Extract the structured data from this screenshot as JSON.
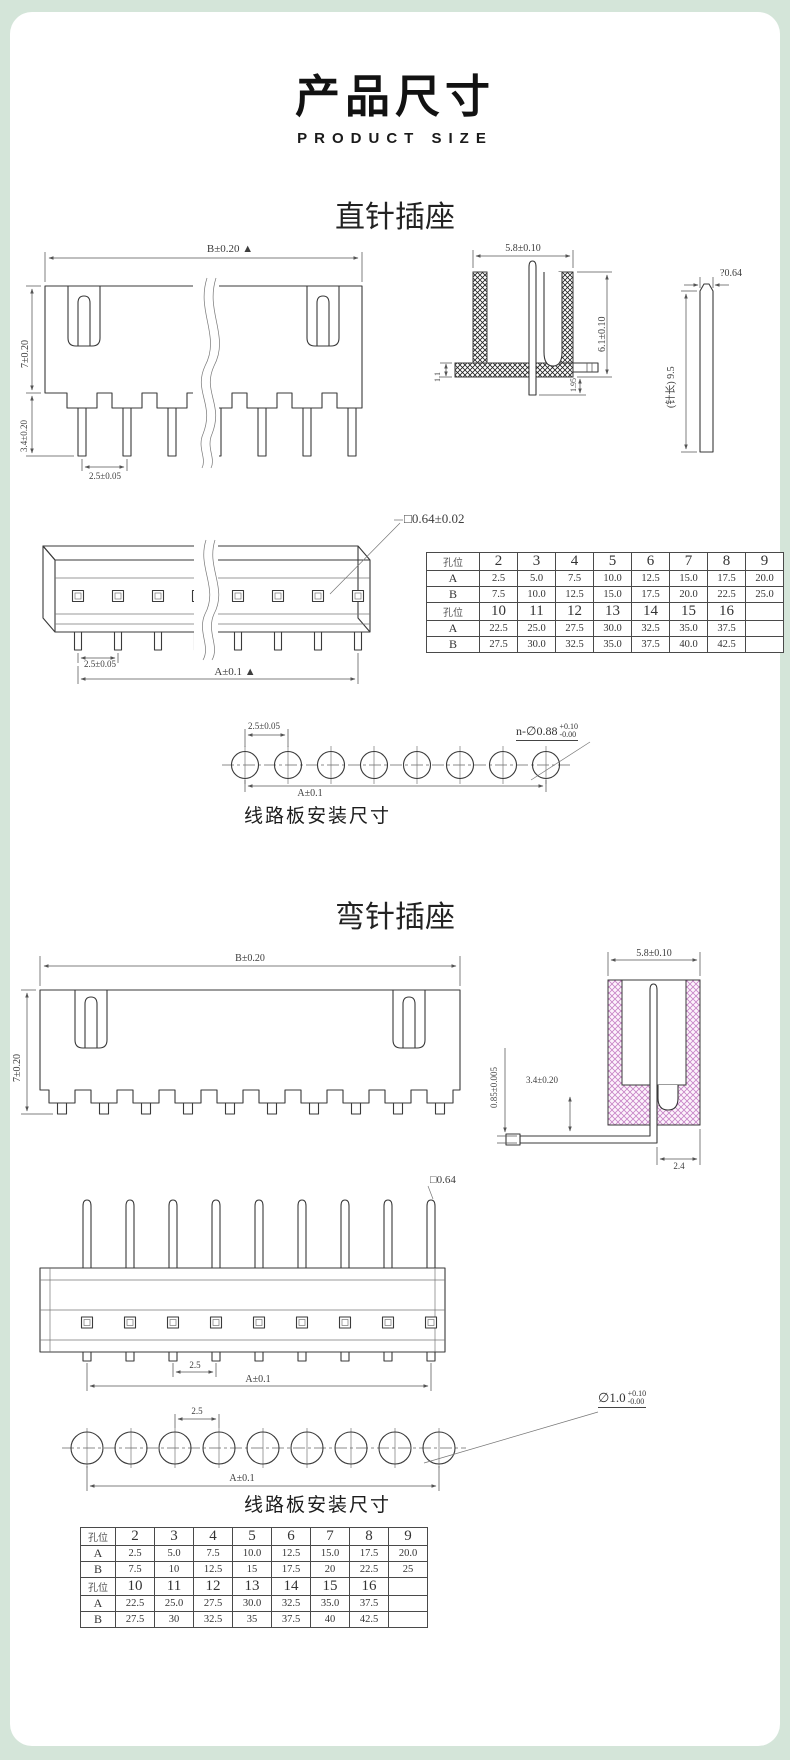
{
  "page": {
    "title": "产品尺寸",
    "subtitle": "PRODUCT SIZE",
    "bg_color": "#d4e5d9",
    "card_color": "#ffffff",
    "line_color": "#3a3a3a",
    "pink_hatch_color": "#c683c6"
  },
  "straight": {
    "heading": "直针插座",
    "front": {
      "dim_width": "B±0.20 ▲",
      "dim_height": "7±0.20",
      "dim_pin": "3.4±0.20",
      "dim_pitch": "2.5±0.05"
    },
    "side": {
      "dim_width": "5.8±0.10",
      "dim_height": "6.1±0.10",
      "dim_base": "1.1",
      "dim_tail": "1.95"
    },
    "pin": {
      "dim_square": "?0.64",
      "dim_length": "(针长) 9.5"
    },
    "iso": {
      "dim_square": "□0.64±0.02",
      "dim_pitch": "2.5±0.05",
      "dim_a": "A±0.1 ▲"
    },
    "pcb": {
      "dim_pitch": "2.5±0.05",
      "hole_prefix": "n-∅0.88",
      "tol_up": "+0.10",
      "tol_dn": "-0.00",
      "dim_a": "A±0.1",
      "caption": "线路板安装尺寸"
    },
    "table": {
      "rows": [
        {
          "label": "孔位",
          "header": true,
          "values": [
            "2",
            "3",
            "4",
            "5",
            "6",
            "7",
            "8",
            "9"
          ]
        },
        {
          "label": "A",
          "header": false,
          "values": [
            "2.5",
            "5.0",
            "7.5",
            "10.0",
            "12.5",
            "15.0",
            "17.5",
            "20.0"
          ]
        },
        {
          "label": "B",
          "header": false,
          "values": [
            "7.5",
            "10.0",
            "12.5",
            "15.0",
            "17.5",
            "20.0",
            "22.5",
            "25.0"
          ]
        },
        {
          "label": "孔位",
          "header": true,
          "values": [
            "10",
            "11",
            "12",
            "13",
            "14",
            "15",
            "16",
            ""
          ]
        },
        {
          "label": "A",
          "header": false,
          "values": [
            "22.5",
            "25.0",
            "27.5",
            "30.0",
            "32.5",
            "35.0",
            "37.5",
            ""
          ]
        },
        {
          "label": "B",
          "header": false,
          "values": [
            "27.5",
            "30.0",
            "32.5",
            "35.0",
            "37.5",
            "40.0",
            "42.5",
            ""
          ]
        }
      ]
    }
  },
  "bent": {
    "heading": "弯针插座",
    "front": {
      "dim_width": "B±0.20",
      "dim_height": "7±0.20"
    },
    "side": {
      "dim_width": "5.8±0.10",
      "dim_pin": "0.85±0.005",
      "dim_height": "3.4±0.20",
      "dim_tail": "2.4"
    },
    "bottom": {
      "dim_square": "□0.64",
      "dim_pitch": "2.5",
      "dim_a": "A±0.1"
    },
    "pcb": {
      "dim_pitch": "2.5",
      "hole_prefix": "∅1.0",
      "tol_up": "+0.10",
      "tol_dn": "-0.00",
      "dim_a": "A±0.1",
      "caption": "线路板安装尺寸"
    },
    "table": {
      "rows": [
        {
          "label": "孔位",
          "header": true,
          "values": [
            "2",
            "3",
            "4",
            "5",
            "6",
            "7",
            "8",
            "9"
          ]
        },
        {
          "label": "A",
          "header": false,
          "values": [
            "2.5",
            "5.0",
            "7.5",
            "10.0",
            "12.5",
            "15.0",
            "17.5",
            "20.0"
          ]
        },
        {
          "label": "B",
          "header": false,
          "values": [
            "7.5",
            "10",
            "12.5",
            "15",
            "17.5",
            "20",
            "22.5",
            "25"
          ]
        },
        {
          "label": "孔位",
          "header": true,
          "values": [
            "10",
            "11",
            "12",
            "13",
            "14",
            "15",
            "16",
            ""
          ]
        },
        {
          "label": "A",
          "header": false,
          "values": [
            "22.5",
            "25.0",
            "27.5",
            "30.0",
            "32.5",
            "35.0",
            "37.5",
            ""
          ]
        },
        {
          "label": "B",
          "header": false,
          "values": [
            "27.5",
            "30",
            "32.5",
            "35",
            "37.5",
            "40",
            "42.5",
            ""
          ]
        }
      ]
    }
  }
}
